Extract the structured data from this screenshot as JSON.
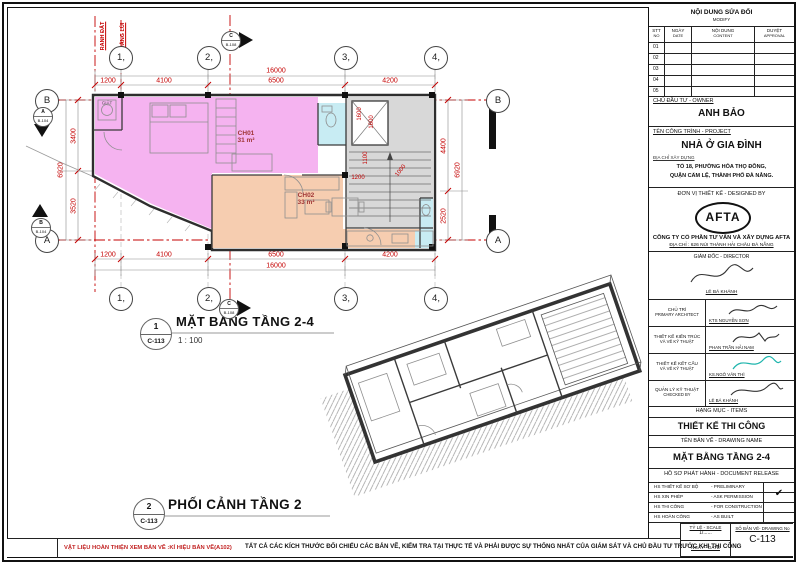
{
  "sheet": {
    "number": "C-113"
  },
  "plan": {
    "title": "MẶT BẰNG TẦNG 2-4",
    "scale_text": "1 : 100",
    "ref": {
      "no": "1",
      "sheet": "C-113"
    },
    "grid_cols": [
      "1,",
      "2,",
      "3,",
      "4,"
    ],
    "grid_row_top": "B",
    "grid_row_bottom": "A",
    "boundary": {
      "l1": "RANH ĐẤT",
      "l2": "KHOẢNG LÙI"
    },
    "dims": {
      "top_total": "16000",
      "top": [
        "1200",
        "4100",
        "6500",
        "4200"
      ],
      "bottom": [
        "1200",
        "4100",
        "6500",
        "4200"
      ],
      "bottom_total": "16000",
      "left": [
        "3400",
        "3520"
      ],
      "left_total": "6920",
      "right": [
        "4400",
        "2520"
      ],
      "right_total": "6920",
      "inner": [
        "1600",
        "1600",
        "1100",
        "1200",
        "1000"
      ]
    },
    "rooms": {
      "r1": {
        "name": "CH01",
        "area": "31 m²"
      },
      "r2": {
        "name": "CH02",
        "area": "33 m²"
      },
      "r3": {
        "name": "GIẶT"
      }
    },
    "sections": {
      "top": {
        "no": "C",
        "sheet": "B-108"
      },
      "bottom": {
        "no": "C",
        "sheet": "B-108"
      },
      "left_a": {
        "no": "A",
        "sheet": "B-104"
      },
      "left_b": {
        "no": "B",
        "sheet": "B-104"
      }
    }
  },
  "perspective": {
    "title": "PHỐI CẢNH TẦNG 2",
    "ref": {
      "no": "2",
      "sheet": "C-113"
    }
  },
  "notes": {
    "left": "VẬT LIỆU HOÀN THIỆN XEM BẢN VẼ :KÍ HIỆU BẢN VẼ(A102)",
    "center": "TẤT CẢ CÁC KÍCH THƯỚC ĐỐI CHIẾU CÁC BẢN VẼ, KIỂM TRA TẠI THỰC TẾ VÀ PHẢI ĐƯỢC SỰ THỐNG NHẤT CỦA GIÁM SÁT VÀ CHỦ ĐẦU TƯ TRƯỚC KHI THI CÔNG"
  },
  "title_block": {
    "modify": {
      "title": "NỘI DUNG SỬA ĐỔI",
      "subtitle": "MODIFY",
      "col1a": "STT",
      "col1b": "NO",
      "col2a": "NGÀY",
      "col2b": "DATE",
      "col3a": "NỘI DUNG",
      "col3b": "CONTENT",
      "col4a": "DUYỆT",
      "col4b": "APPROVAL",
      "rows": [
        "01",
        "02",
        "03",
        "04",
        "05"
      ]
    },
    "owner": {
      "label": "CHỦ ĐẦU TƯ - OWNER",
      "name": "ANH BẢO"
    },
    "project": {
      "label": "TÊN CÔNG TRÌNH - PROJECT",
      "name": "NHÀ Ở GIA ĐÌNH",
      "address_label": "ĐỊA CHỈ XÂY DỰNG",
      "address1": "TỔ 18, PHƯỜNG HÒA THỌ ĐÔNG,",
      "address2": "QUẬN CẨM LỆ, THÀNH PHỐ ĐÀ NẴNG."
    },
    "designer": {
      "label": "ĐƠN VỊ THIẾT KẾ - DESIGNED BY",
      "logo": "AFTA",
      "company": "CÔNG TY CỔ PHẦN TƯ VẤN VÀ XÂY DỰNG AFTA",
      "address": "ĐỊA CHỈ : 626 NÚI THÀNH HẢI CHÂU ĐÀ NẴNG"
    },
    "director": {
      "label": "GIÁM ĐỐC - DIRECTOR",
      "name": "LÊ BÁ KHÁNH"
    },
    "staff": [
      {
        "role1": "CHỦ TRÌ",
        "role2": "PRIMARY ARCHITECT",
        "name": "KTS NGUYỄN SƠN"
      },
      {
        "role1": "THIẾT KẾ KIẾN TRÚC",
        "role2": "VÀ VẼ KỸ THUẬT",
        "name": "PHAN TRẦN HẢI NAM"
      },
      {
        "role1": "THIẾT KẾ KẾT CẤU",
        "role2": "VÀ VẼ KỸ THUẬT",
        "name": "KS.NGÔ VĂN THÌ"
      },
      {
        "role1": "QUẢN LÝ KỸ THUẬT",
        "role2": "CHECKED BY",
        "name": "LÊ BÁ KHÁNH"
      }
    ],
    "items": {
      "label": "HẠNG MỤC - ITEMS",
      "value": "THIẾT KẾ THI CÔNG"
    },
    "drawing_name": {
      "label": "TÊN BẢN VẼ - DRAWING NAME",
      "value": "MẶT BẰNG TẦNG 2-4"
    },
    "release": {
      "label": "HỒ SƠ PHÁT HÀNH - DOCUMENT RELEASE",
      "rows": [
        {
          "vi": "HS THIẾT KẾ SƠ BỘ",
          "en": "- PRELIMINARY",
          "mark": "✔"
        },
        {
          "vi": "HS XIN PHÉP",
          "en": "- ASK PERMISSION",
          "mark": ""
        },
        {
          "vi": "HS THI CÔNG",
          "en": "- FOR CONSTRUCTION",
          "mark": ""
        },
        {
          "vi": "HS HOÀN CÔNG",
          "en": "- AS BUILT",
          "mark": ""
        }
      ]
    },
    "scale": {
      "label": "TỶ LỆ - SCALE",
      "value": "1/......"
    },
    "date_label": "NGÀY - DATE",
    "number": {
      "label": "SỐ BẢN VẼ- DRAWING No",
      "value": "C-113"
    }
  }
}
